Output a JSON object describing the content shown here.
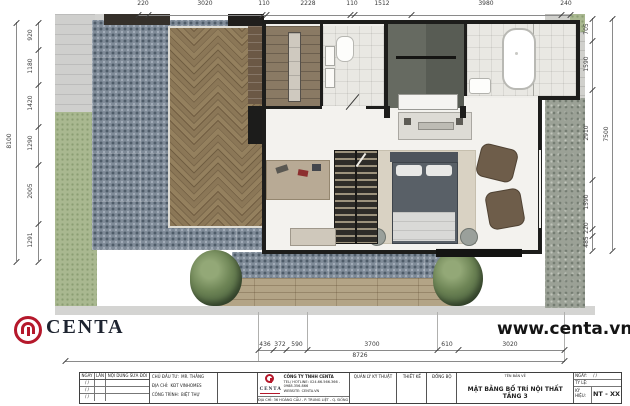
{
  "branding": {
    "logo_text": "CENTA",
    "website": "www.centa.vn"
  },
  "dimensions": {
    "top": {
      "values": [
        "220",
        "3020",
        "110",
        "2228",
        "110",
        "1512",
        "3980",
        "240"
      ]
    },
    "left": {
      "values": [
        "920",
        "1180",
        "1420",
        "1290",
        "2005",
        "1291"
      ],
      "total": "8100"
    },
    "right": {
      "values": [
        "705",
        "1590",
        "2910",
        "1590",
        "220",
        "485"
      ],
      "total": "7500"
    },
    "bottom": {
      "values": [
        "436",
        "372",
        "590",
        "3700",
        "610",
        "3020"
      ],
      "total": "8726"
    }
  },
  "title_block": {
    "revision": {
      "headers": [
        "NGÀY",
        "LẦN",
        "NỘI DUNG SỬA ĐỔI"
      ],
      "rows": [
        "/  /",
        "/  /",
        "/  /"
      ]
    },
    "project_info": {
      "owner_label": "CHỦ ĐẦU TƯ:",
      "owner": "MR. THẮNG",
      "addr_label": "ĐỊA CHỈ:",
      "addr": "KĐT VINHOMES",
      "project_label": "CÔNG TRÌNH:",
      "project": "BIỆT THỰ"
    },
    "company": {
      "logo_text": "CENTA",
      "name": "CÔNG TY TNHH CENTA",
      "tel": "TEL/ HOTLINE: 024.66.566.366 - 0988.356.866",
      "website": "WEBSITE: CENTA.VN",
      "address": "ĐỊA CHỈ: 36 HOÀNG CẦU - P. TRUNG LIỆT - Q. ĐỐNG ĐA - HÀ NỘI"
    },
    "signatures": [
      "QUẢN LÝ KỸ THUẬT",
      "THIẾT KẾ",
      "ĐỒNG BỘ"
    ],
    "drawing": {
      "name_label": "TÊN BẢN VẼ",
      "title": "MẶT BẰNG BỐ TRÍ NỘI THẤT TẦNG 3",
      "date_label": "NGÀY:",
      "date_value": "/    /",
      "scale_label": "TỶ LỆ:",
      "code_label": "KÝ HIỆU:",
      "code": "NT - XX"
    }
  }
}
